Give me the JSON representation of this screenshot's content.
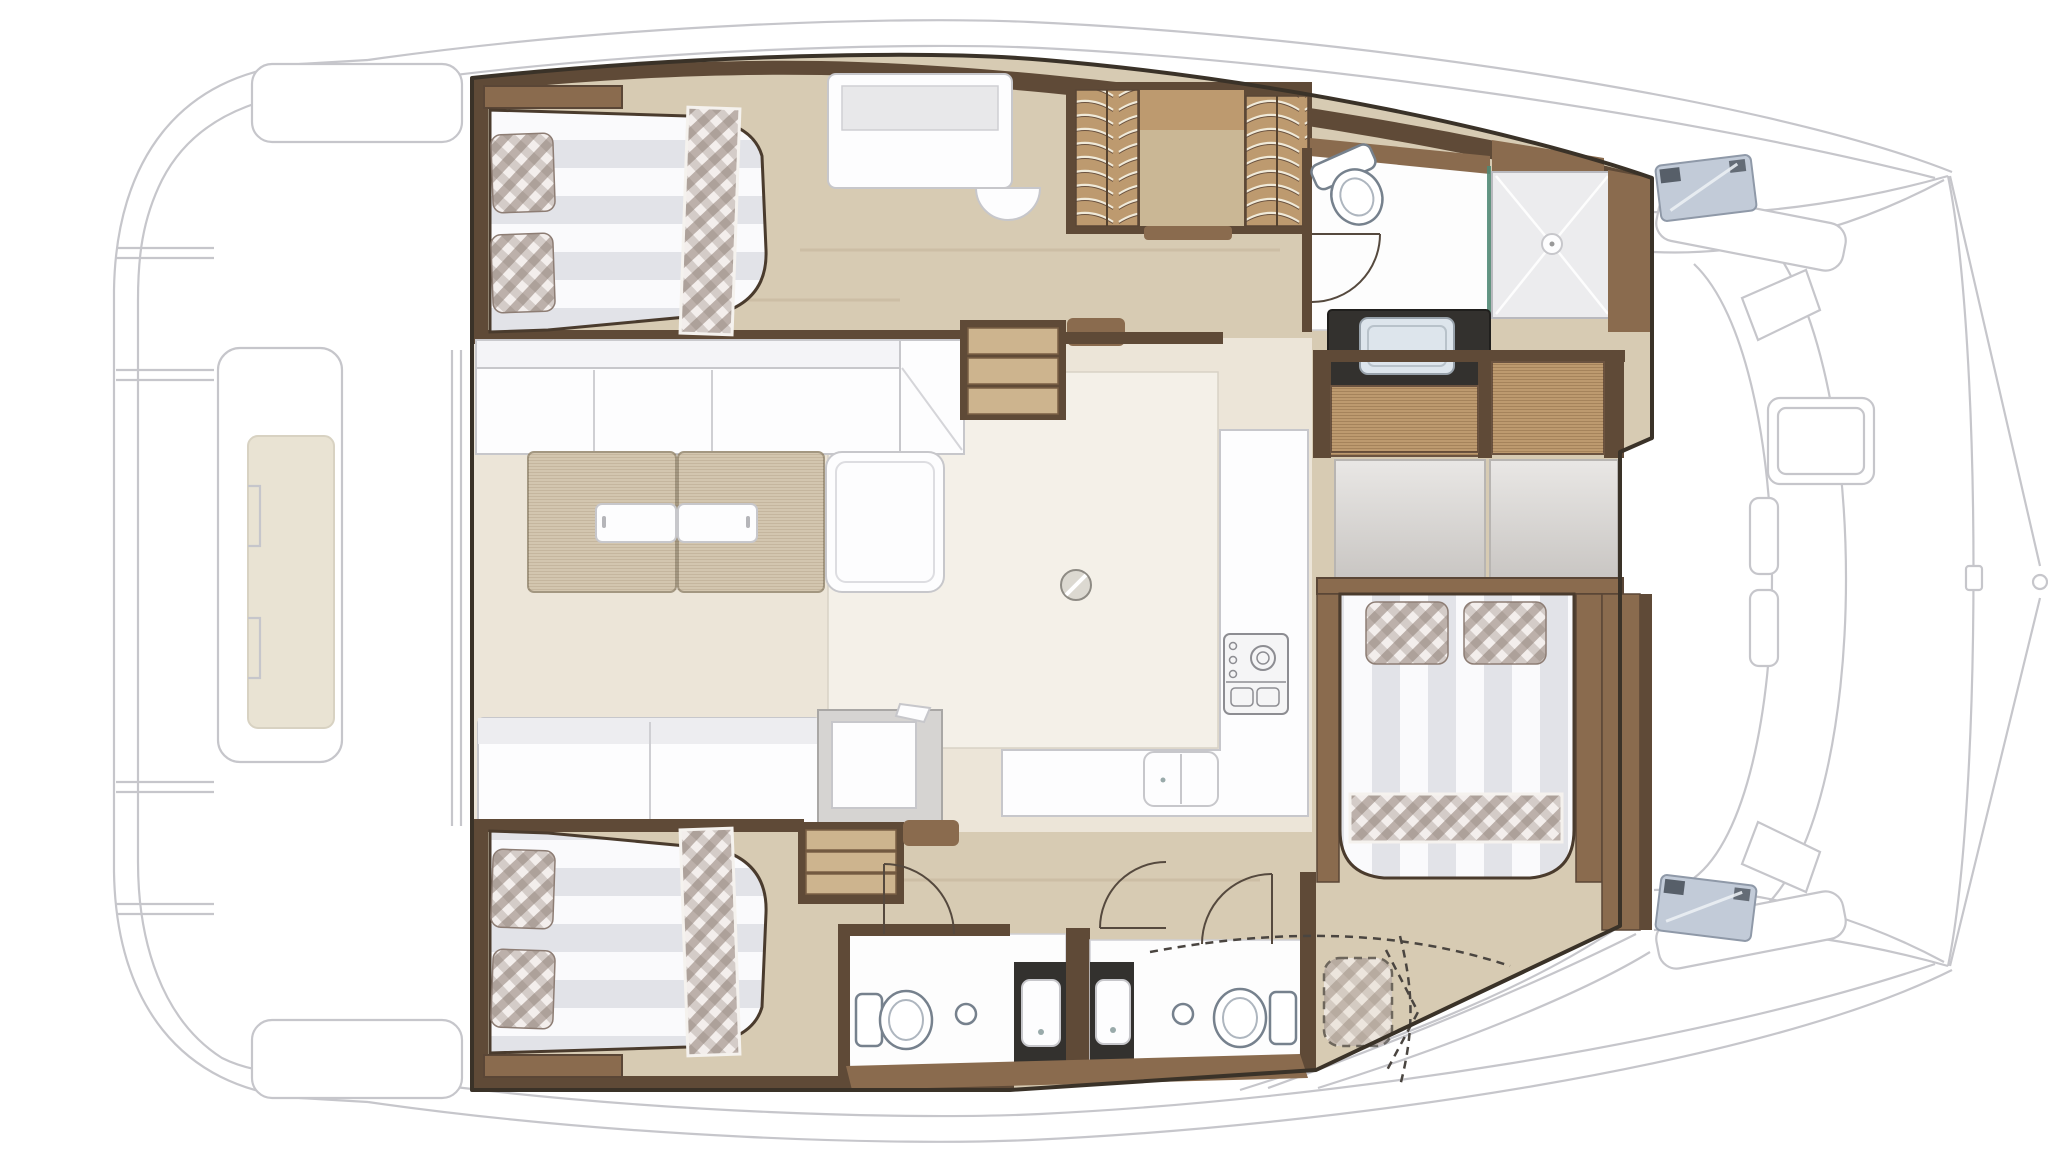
{
  "diagram": {
    "kind": "yacht-floorplan",
    "subject": "catamaran-interior-layout-top-view",
    "visible_text": "none"
  },
  "colors": {
    "outline": "#3a3228",
    "ghost_line": "#c6c6cb",
    "floor_hull": "#d7cbb3",
    "floor_salon": "#ece5d8",
    "floor_salon_light": "#f4f0e8",
    "wood_dark": "#5f4a37",
    "wood_mid": "#8a6b4e",
    "wood_tan": "#bd9a6f",
    "wood_tan_light": "#cdb48e",
    "shelf_beige": "#cab795",
    "counter_dark": "#33312e",
    "table_tan": "#d3c6af",
    "hatch_blue": "#c2cbd8",
    "glass_teal": "#4e8a76",
    "sink_steel": "#dde5ec",
    "plaid_base": "#f3eeec",
    "plaid_dark": "#8d7d74",
    "stripe_dark": "#e2e3e8",
    "beige_inset": "#e9e3d3",
    "gray_panel_light": "#e9e7e5",
    "gray_panel_dark": "#c9c6c3"
  },
  "areas": {
    "aft_deck": {
      "items": [
        "swim-platform-steps",
        "cockpit-table-module",
        "cockpit-benches"
      ]
    },
    "port_hull": {
      "items": [
        "double-bed",
        "plaid-pillows-2",
        "plaid-runner",
        "headboard-shelf",
        "desk",
        "stool",
        "hanging-wardrobe-2",
        "shelf-unit",
        "toilet",
        "door",
        "shower",
        "shower-drain",
        "glass-partition",
        "dark-counter",
        "steel-sink",
        "tan-lockers"
      ]
    },
    "salon": {
      "items": [
        "l-sofa",
        "dining-table-2-leaf",
        "table-inserts-2",
        "chaise",
        "aft-bench",
        "chart-station",
        "round-floor-hatch",
        "stairs-port",
        "stairs-starboard"
      ]
    },
    "galley": {
      "items": [
        "l-counter",
        "cooktop",
        "double-sink"
      ]
    },
    "forward_cabin": {
      "items": [
        "double-bed",
        "plaid-pillows-2",
        "plaid-runner",
        "headboard-panels-2",
        "tan-locker-doors-2",
        "side-wardrobe"
      ]
    },
    "starboard_hull": {
      "items": [
        "double-bed",
        "plaid-pillows-2",
        "plaid-runner",
        "headboard-shelf",
        "bathroom-1-toilet",
        "bathroom-1-vanity-sink",
        "bathroom-2-toilet",
        "bathroom-2-vanity-sink",
        "faucet-knobs-2",
        "door-arcs-3",
        "optional-berth-dashed"
      ]
    },
    "foredeck": {
      "items": [
        "lounge-benches-2",
        "backrests-2",
        "sun-pad",
        "deck-hatches-2",
        "trampoline-curves",
        "bow-bridle",
        "mast-step"
      ]
    }
  }
}
